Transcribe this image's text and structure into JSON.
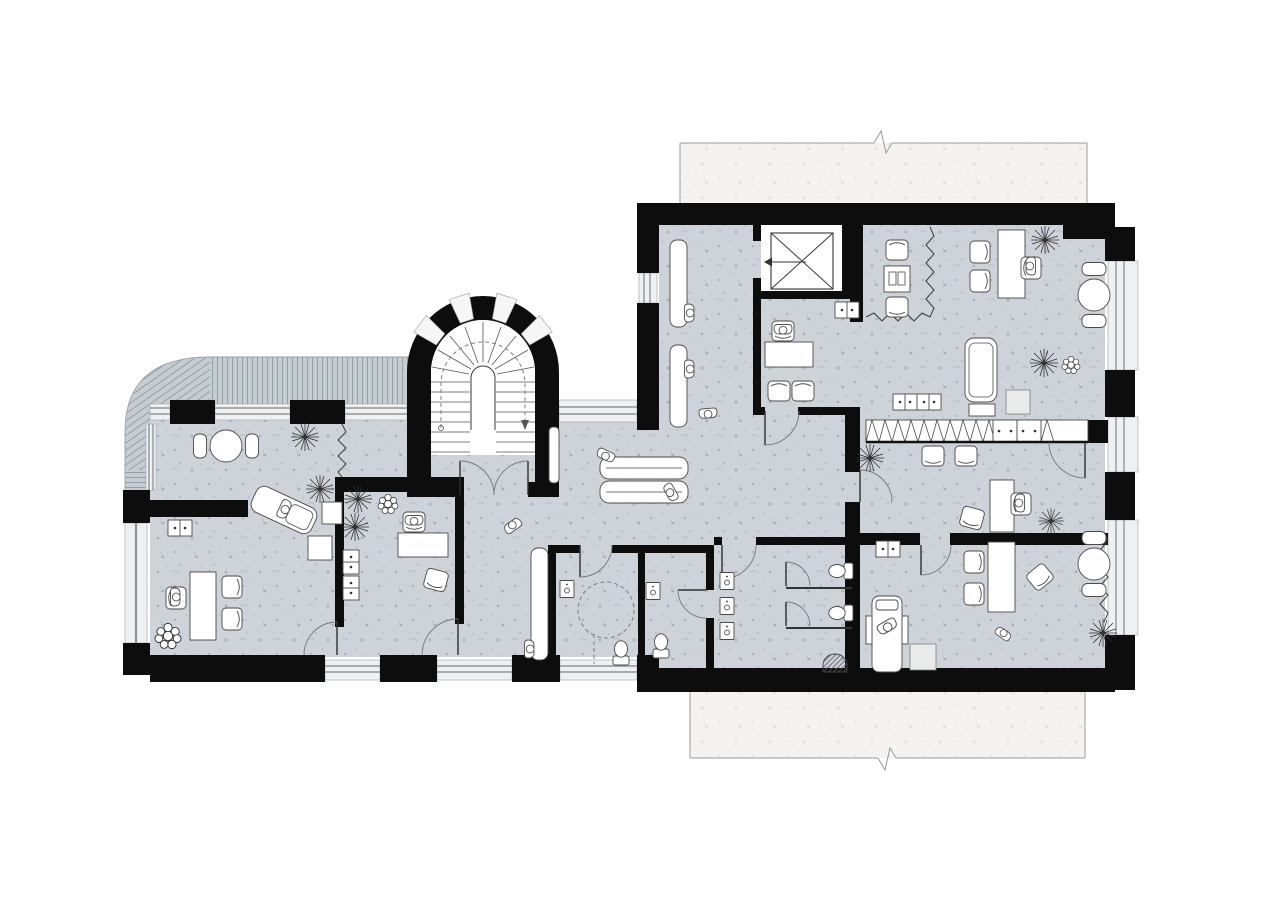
{
  "document": {
    "kind": "architectural-floor-plan",
    "view": "top-down plan drawing",
    "style": "monochrome ink linework, black poche walls, blue-grey floor wash, white paper",
    "text_labels": []
  },
  "palette": {
    "background": "#ffffff",
    "floor_wash": "#cdd3d8",
    "floor_speckle": "#7e939f",
    "balcony_paper": "#f4f3f1",
    "deck": "#c6cdd2",
    "deck_stripe": "#95a0a7",
    "wall_poche": "#0d0d0d",
    "window_glass": "#eef0f1",
    "window_frame": "#8d9499",
    "linework": "#4a4a4a",
    "door_swing": "#777777",
    "fixture_fill": "#ffffff"
  },
  "inventory": {
    "people": 15,
    "plants": 12,
    "door_openings": 12,
    "window_bands": 13,
    "toilets": 4,
    "urinals": 1,
    "washbasins": 5,
    "desks": 6,
    "chairs": 20,
    "benches": 3,
    "round_tables": 3,
    "daybeds": 2,
    "lounge_recliners": 1,
    "massage_tables": 1,
    "elevators": 1,
    "curved_staircases": 1,
    "balconies": 2,
    "roof_decks": 1,
    "wardrobe_runs": 1,
    "storage_cabinets": 9,
    "turning_circles": 1,
    "break_line_symbols": 2,
    "curtain_partitions": 4
  },
  "areas": [
    {
      "id": "stair-tower",
      "features": [
        "curved-fan-staircase",
        "arched-glazed-wall",
        "double-door",
        "walk-line-arrow"
      ]
    },
    {
      "id": "roof-deck-northwest",
      "features": [
        "striped-decking",
        "curved-corner"
      ]
    },
    {
      "id": "balcony-north",
      "features": [
        "break-line"
      ]
    },
    {
      "id": "balcony-south",
      "features": [
        "break-line"
      ]
    },
    {
      "id": "elevator-lobby",
      "features": [
        "elevator-shaft",
        "waiting-benches",
        "seated-people"
      ]
    },
    {
      "id": "office-north",
      "features": [
        "desk",
        "task-chair",
        "two-visitor-chairs",
        "cabinet"
      ]
    },
    {
      "id": "open-room-northeast",
      "features": [
        "armchair-nook",
        "curtain-partition",
        "island-desk",
        "daybed-couch",
        "round-table",
        "plants"
      ]
    },
    {
      "id": "wardrobe-wall",
      "features": [
        "x-pattern-wardrobe",
        "two-cabinets"
      ]
    },
    {
      "id": "room-east",
      "features": [
        "two-chairs",
        "desk",
        "armchair",
        "plants",
        "doors"
      ]
    },
    {
      "id": "room-southeast",
      "features": [
        "massage-table",
        "desk",
        "chairs",
        "round-table",
        "curtain",
        "plants"
      ]
    },
    {
      "id": "wc-cluster",
      "features": [
        "accessible-wc",
        "turning-circle",
        "small-wc",
        "two-toilet-stalls",
        "three-washbasins",
        "urinal"
      ]
    },
    {
      "id": "lounge-hall",
      "features": [
        "daybed",
        "corridor-bench",
        "people"
      ]
    },
    {
      "id": "room-west",
      "features": [
        "round-table",
        "lounge-recliner",
        "side-tables",
        "curtain",
        "plants"
      ]
    },
    {
      "id": "office-west-small",
      "features": [
        "desk",
        "chair",
        "cabinets",
        "plants"
      ]
    },
    {
      "id": "office-southwest",
      "features": [
        "desk",
        "two-chairs",
        "plant",
        "cabinet"
      ]
    }
  ]
}
